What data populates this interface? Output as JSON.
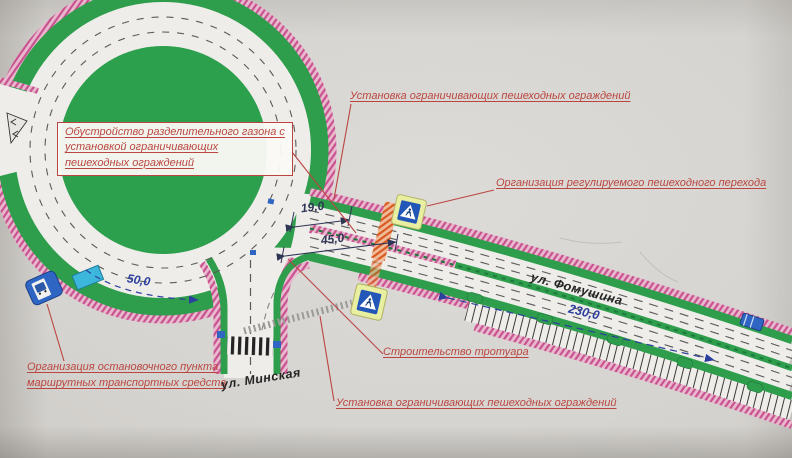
{
  "plan": {
    "labels": {
      "fence_top": "Установка ограничивающих пешеходных ограждений",
      "median_line1": "Обустройство разделительного газона с",
      "median_line2": "установкой ограничивающих",
      "median_line3": "пешеходных ограждений",
      "crossing": "Организация регулируемого пешеходного перехода",
      "bus_line1": "Организация остановочного пункта",
      "bus_line2": "маршрутных транспортных средств",
      "sidewalk": "Строительство тротуара",
      "fence_bottom": "Установка ограничивающих пешеходных ограждений"
    },
    "streets": {
      "minskaya": "ул. Минская",
      "fomushina": "ул. Фомушина"
    },
    "dimensions": {
      "d19": "19,0",
      "d45": "45,0",
      "d50": "50,0",
      "d230": "230,0"
    },
    "icons": {
      "pedestrian_crossing_sign": "blue-square-white-triangle-walker",
      "bus_stop_sign": "blue-square-bus",
      "bus_shelter": "cyan-canopy"
    },
    "colors": {
      "lawn_green": "#2e9e4c",
      "fence_pink_hatch": "#c85290",
      "crossing_orange_hatch": "#d85a20",
      "annotation_red": "#bb4540",
      "dimension_blue": "#2b3f9e",
      "dimension_dark": "#2f3555",
      "sign_blue": "#2f66c4",
      "sign_yellow_border": "#e9efa0",
      "road_white": "#efedea"
    }
  }
}
